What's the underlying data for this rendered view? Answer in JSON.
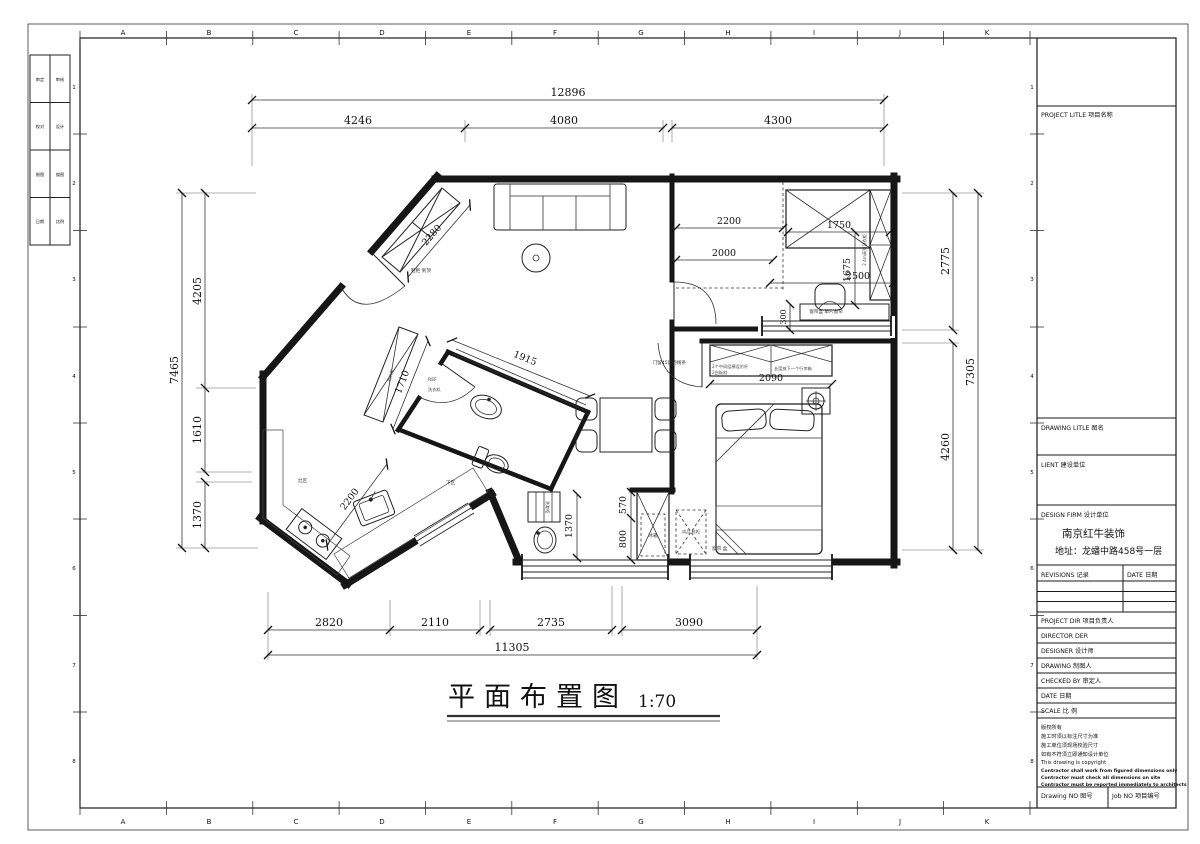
{
  "sheet": {
    "columns": [
      "A",
      "B",
      "C",
      "D",
      "E",
      "F",
      "G",
      "H",
      "I",
      "J",
      "K"
    ],
    "row_numbers": [
      "1",
      "2",
      "3",
      "4",
      "5",
      "6",
      "7",
      "8"
    ],
    "left_strip": [
      "审定",
      "审核",
      "校对",
      "设计",
      "制图",
      "描图",
      "日期",
      "比例"
    ]
  },
  "titleblock": {
    "project_title": "PROJECT LITLE  项目名称",
    "drawing_title": "DRAWING LITLE  图名",
    "client": "LIENT  建设单位",
    "design_firm": "DESIGN FIRM  设计单位",
    "firm_name": "南京红牛装饰",
    "firm_address": "地址：龙蟠中路458号一层",
    "revisions": "REVISIONS  记录",
    "date_col": "DATE  日期",
    "project_dir": "PROJECT DIR  项目负责人",
    "director": "DIRECTOR DER",
    "designer": "DESIGNER  设计师",
    "drawing": "DRAWING  制图人",
    "checked_by": "CHECKED BY  审定人",
    "date": "DATE  日期",
    "scale": "SCALE  比 例",
    "copyright": [
      "版权所有",
      "施工时须以标注尺寸为准",
      "施工单位须现场校验尺寸",
      "如有不符须立即通知设计单位",
      "This drawing is copyright"
    ],
    "copyright_en": [
      "Contractor shall work from figured dimensions only",
      "Contractor must check all dimensions on site",
      "Contractor must be reported immediately to architects"
    ],
    "drawing_no": "Drawing NO  图号",
    "job_no": "Job NO  项目编号"
  },
  "plan": {
    "title": "平面布置图",
    "scale_text": "1:70",
    "dims": {
      "t_total": "12896",
      "t1": "4246",
      "t2": "4080",
      "t3": "4300",
      "l_total": "7465",
      "l1": "4205",
      "l2": "1610",
      "l3": "1370",
      "r_total": "7305",
      "r1": "2775",
      "r2": "4260",
      "b1": "2820",
      "b2": "2110",
      "b3": "2735",
      "b4": "3090",
      "b_total": "11305",
      "entry": "2280",
      "hall": "1915",
      "washer": "1710",
      "kitchen": "2200",
      "s1": "2200",
      "s2": "2000",
      "s3": "1750",
      "s4": "1675",
      "s5": "2500",
      "s6": "300",
      "wardrobe": "2090",
      "vanity": "1370",
      "fr1": "570",
      "fr2": "800"
    },
    "labels": {
      "door45": "门留45度的线条",
      "shoe": "鞋柜 到顶",
      "note1": "2个中间层横设吊杆",
      "note2": "2白板材",
      "note3": "长度放下一个行李箱",
      "curtain_single": "窗帘盒 单片窗帘",
      "curtain_box": "窗帘 盒",
      "ready": "成品 鞋柜",
      "fridge": "冰箱",
      "ref": "REF",
      "washer": "洗衣机",
      "storage": "收纳柜",
      "tall": "2.4m高到顶衣柜",
      "stove_area": "灶区",
      "lower_area": "下区",
      "vanity_cab": "洗漱柜"
    }
  }
}
